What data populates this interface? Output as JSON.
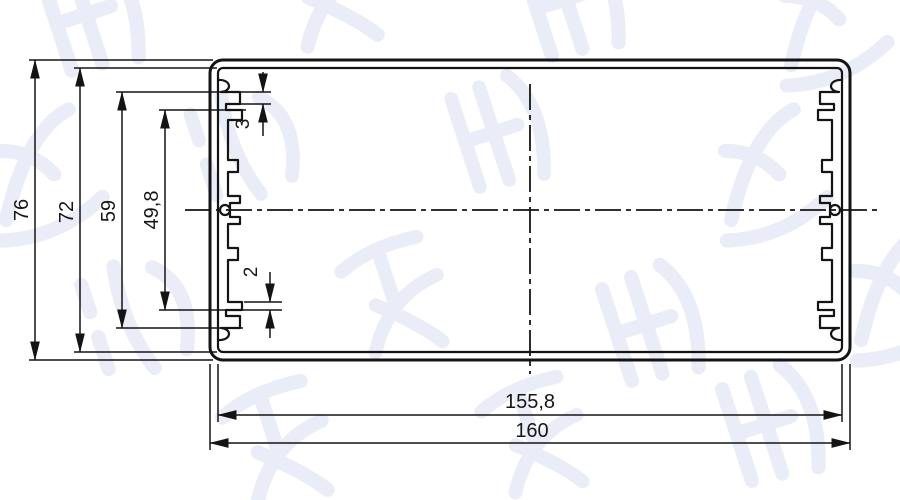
{
  "drawing": {
    "title": "aluminum-extrusion-profile-cross-section",
    "dims": {
      "d76": {
        "label": "76"
      },
      "d72": {
        "label": "72"
      },
      "d59": {
        "label": "59"
      },
      "d49_8": {
        "label": "49,8"
      },
      "d3": {
        "label": "3"
      },
      "d2": {
        "label": "2"
      },
      "d155_8": {
        "label": "155,8"
      },
      "d160": {
        "label": "160"
      }
    }
  },
  "watermark": {
    "text": "鸿发顺达",
    "color": "#7d8cc8"
  },
  "colors": {
    "line": "#141414",
    "background": "#ffffff"
  }
}
